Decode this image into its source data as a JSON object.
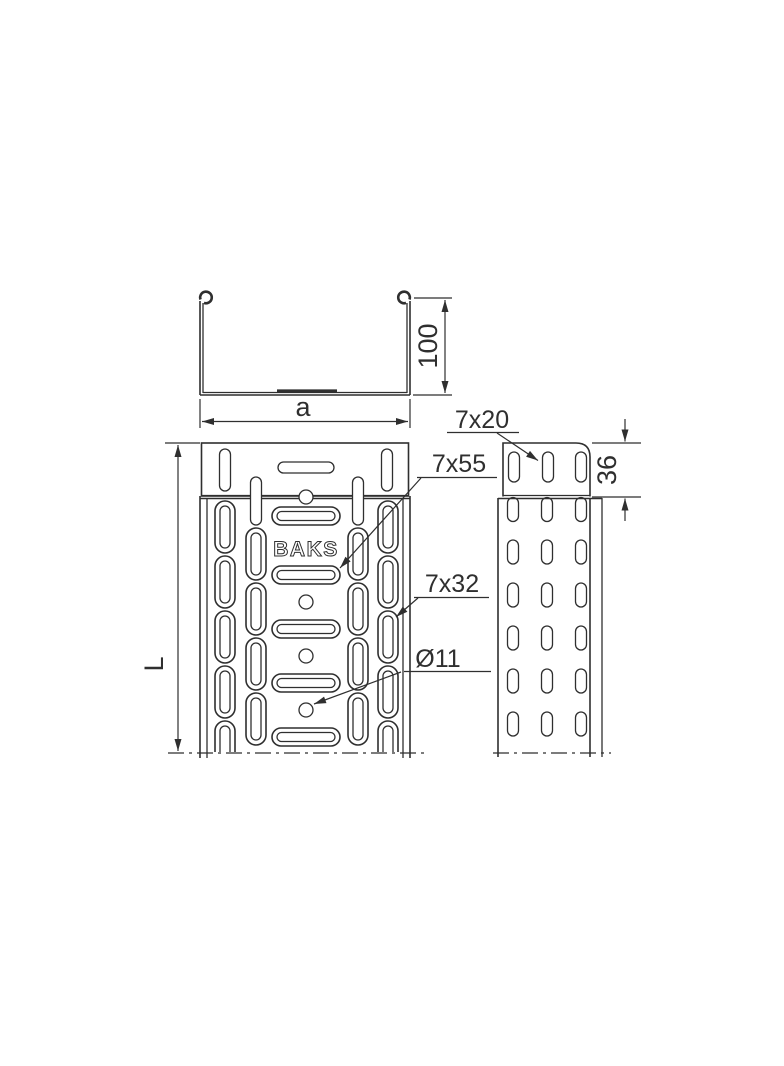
{
  "brand": "BAKS",
  "dimensions": {
    "section_width": "a",
    "section_height": "100",
    "tray_length": "L",
    "end_flange_height": "36"
  },
  "callouts": {
    "end_flange_slot": "7x20",
    "bottom_center_slot": "7x55",
    "bottom_side_slot": "7x32",
    "mounting_hole": "Ø11"
  },
  "colors": {
    "line": "#2f2f2f",
    "background": "#ffffff"
  }
}
